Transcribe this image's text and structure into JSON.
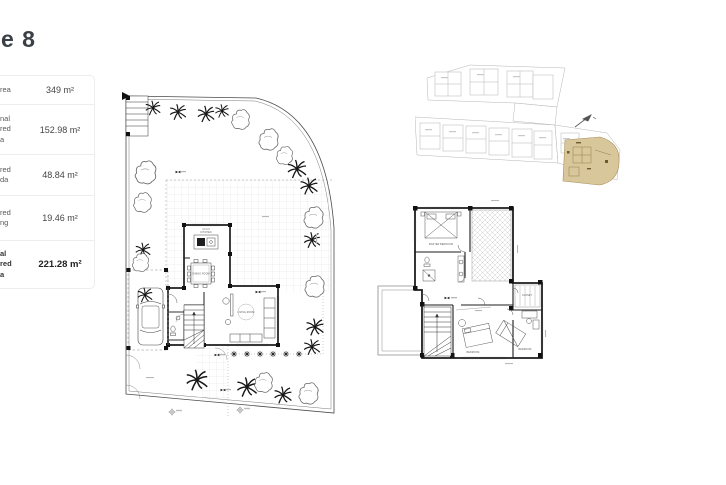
{
  "page": {
    "title_fragment": "e 8"
  },
  "area_table": {
    "rows": [
      {
        "label": "rea",
        "value": "349 m²",
        "bold": false
      },
      {
        "label": "nal\nred\na",
        "value": "152.98 m²",
        "bold": false
      },
      {
        "label": "red\nda",
        "value": "48.84 m²",
        "bold": false
      },
      {
        "label": "red\nng",
        "value": "19.46 m²",
        "bold": false
      },
      {
        "label": "al\nred\na",
        "value": "221.28 m²",
        "bold": true
      }
    ]
  },
  "ground_floor": {
    "labels": {
      "kitchen": "KITCHEN",
      "dining": "DINING ROOM",
      "living": "LIVING ROOM"
    }
  },
  "first_floor": {
    "labels": {
      "master_bedroom": "MASTER BEDROOM",
      "bedroom_center": "BEDROOM",
      "bedroom_right": "BEDROOM",
      "closet": "CLOSET"
    }
  },
  "site_plan": {
    "highlight_color": "#d9c79c",
    "highlight_line_color": "#a8905c",
    "north_arrow_icon": "north-arrow-icon"
  },
  "colors": {
    "wall": "#1d1d1f",
    "thin_line": "#555555",
    "grid": "#d9d9d9",
    "boundary": "#4a4a4a"
  }
}
